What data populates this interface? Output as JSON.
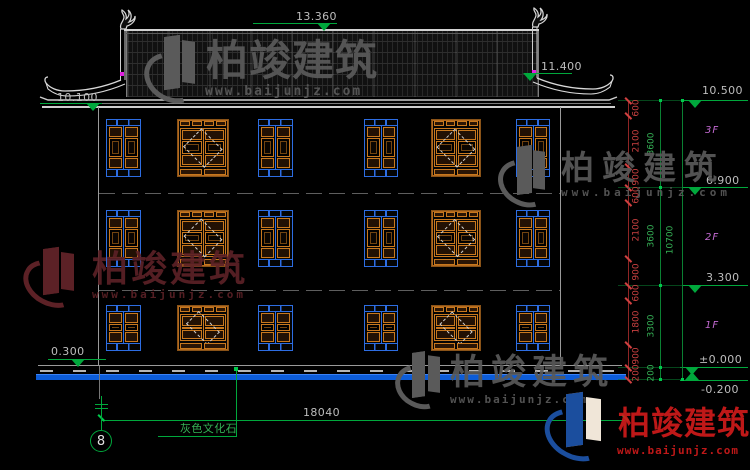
{
  "brand": {
    "name": "柏竣建筑",
    "site": "www.baijunjz.com"
  },
  "drawing": {
    "axis_bubble": "8",
    "material_note": "灰色文化石",
    "total_width_dim": "18040",
    "floor_labels": [
      {
        "text": "3F",
        "x": 705,
        "y": 125
      },
      {
        "text": "2F",
        "x": 705,
        "y": 232
      },
      {
        "text": "1F",
        "x": 705,
        "y": 320
      }
    ],
    "elevation_markers": [
      {
        "label": "13.360",
        "tx": 296,
        "ty": 11,
        "lx": 253,
        "lw": 84,
        "ly": 23,
        "cx": 324,
        "dir": "down"
      },
      {
        "label": "10.100",
        "tx": 57,
        "ty": 92,
        "lx": 40,
        "lw": 62,
        "ly": 103,
        "cx": 93,
        "dir": "down"
      },
      {
        "label": "11.400",
        "tx": 541,
        "ty": 61,
        "lx": 534,
        "lw": 38,
        "ly": 73,
        "cx": 530,
        "dir": "down"
      },
      {
        "label": "10.500",
        "tx": 702,
        "ty": 85,
        "lx": 682,
        "lw": 66,
        "ly": 100,
        "cx": 695,
        "dir": "down"
      },
      {
        "label": "6.900",
        "tx": 706,
        "ty": 175,
        "lx": 682,
        "lw": 66,
        "ly": 187,
        "cx": 695,
        "dir": "down"
      },
      {
        "label": "3.300",
        "tx": 706,
        "ty": 272,
        "lx": 682,
        "lw": 66,
        "ly": 285,
        "cx": 695,
        "dir": "down"
      },
      {
        "label": "±0.000",
        "tx": 699,
        "ty": 354,
        "lx": 680,
        "lw": 68,
        "ly": 367,
        "cx": 692,
        "dir": "down"
      },
      {
        "label": "-0.200",
        "tx": 701,
        "ty": 384,
        "lx": 680,
        "lw": 68,
        "ly": 380,
        "cx": 692,
        "dir": "up"
      },
      {
        "label": "0.300",
        "tx": 51,
        "ty": 346,
        "lx": 48,
        "lw": 58,
        "ly": 359,
        "cx": 78,
        "dir": "down"
      }
    ],
    "dim_chains": [
      {
        "x": 628,
        "label_x": 637,
        "style": "red",
        "bounds": [
          100,
          115,
          166,
          187,
          202,
          258,
          285,
          300,
          344,
          367,
          379
        ],
        "values": [
          "600",
          "2100",
          "900",
          "600",
          "2100",
          "900",
          "600",
          "1800",
          "900",
          "200"
        ]
      },
      {
        "x": 660,
        "label_x": 652,
        "style": "green",
        "bounds": [
          100,
          187,
          285,
          367,
          379
        ],
        "values": [
          "3600",
          "3600",
          "3300",
          "200"
        ]
      },
      {
        "x": 682,
        "label_x": 671,
        "style": "green",
        "bounds": [
          100,
          379
        ],
        "values": [
          "10700"
        ]
      }
    ],
    "windows": {
      "rows": [
        {
          "y": 119,
          "h": 58
        },
        {
          "y": 210,
          "h": 57
        },
        {
          "y": 305,
          "h": 46
        }
      ],
      "cols": [
        {
          "type": "double",
          "x": 106,
          "w": 35
        },
        {
          "type": "lattice",
          "x": 177,
          "w": 52
        },
        {
          "type": "double",
          "x": 258,
          "w": 35
        },
        {
          "type": "double",
          "x": 364,
          "w": 34
        },
        {
          "type": "lattice",
          "x": 431,
          "w": 50
        },
        {
          "type": "double",
          "x": 516,
          "w": 34
        }
      ]
    },
    "watermarks": [
      {
        "theme": "gray",
        "logo": {
          "x": 145,
          "y": 36,
          "w": 56,
          "h": 66
        },
        "brand": {
          "x": 206,
          "y": 40,
          "size": 42,
          "ls": 1
        },
        "url": {
          "x": 205,
          "y": 85,
          "size": 13,
          "ls": 2
        }
      },
      {
        "theme": "gray",
        "logo": {
          "x": 499,
          "y": 146,
          "w": 52,
          "h": 60
        },
        "brand": {
          "x": 561,
          "y": 151,
          "size": 33,
          "ls": 8
        },
        "url": {
          "x": 561,
          "y": 187,
          "size": 11,
          "ls": 4
        }
      },
      {
        "theme": "darkred",
        "logo": {
          "x": 24,
          "y": 248,
          "w": 56,
          "h": 58
        },
        "brand": {
          "x": 92,
          "y": 252,
          "size": 36,
          "ls": 3
        },
        "url": {
          "x": 92,
          "y": 289,
          "size": 11,
          "ls": 3
        }
      },
      {
        "theme": "gray",
        "logo": {
          "x": 396,
          "y": 352,
          "w": 48,
          "h": 56
        },
        "brand": {
          "x": 450,
          "y": 356,
          "size": 35,
          "ls": 6
        },
        "url": {
          "x": 450,
          "y": 394,
          "size": 11,
          "ls": 2
        }
      },
      {
        "theme": "color",
        "logo": {
          "x": 545,
          "y": 393,
          "w": 62,
          "h": 66
        },
        "brand": {
          "x": 618,
          "y": 407,
          "size": 32,
          "ls": 1
        },
        "url": {
          "x": 617,
          "y": 445,
          "size": 11,
          "ls": 1
        }
      }
    ],
    "colors": {
      "green": "#00a83c",
      "green_bright": "#00c84b",
      "dim_red_text": "#c94040",
      "dim_red_line": "#8f2525",
      "dim_green_text": "#35b055",
      "dim_green_line": "#0a8032",
      "window_blue": "#2d6de2",
      "window_orange": "#c8781e",
      "floor_label_magenta": "#c36ad2",
      "ground_blue": "#0c5cd8",
      "wm_gray": "#5a5a5a",
      "wm_darkred": "#5c2126",
      "wm_red": "#cf1b1b",
      "wm_orange": "#e8891a",
      "wm_blue": "#1b4e9e",
      "ridge_ornament_magenta": "#e020e0"
    }
  }
}
